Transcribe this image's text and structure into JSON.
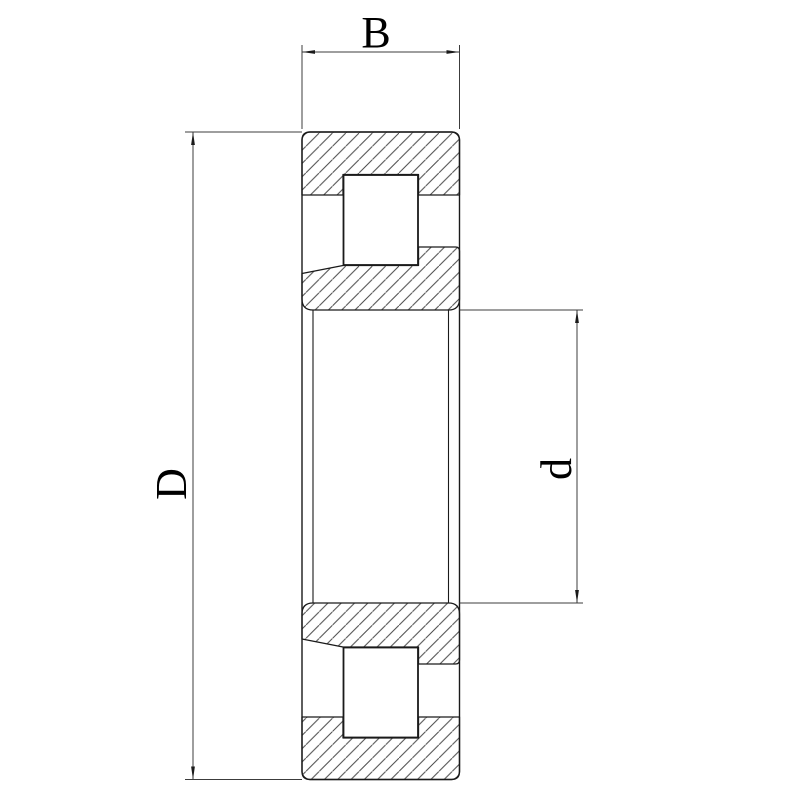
{
  "drawing": {
    "labels": {
      "width": "B",
      "outer_diameter": "D",
      "bore_diameter": "d"
    }
  },
  "colors": {
    "background": "#ffffff",
    "outline": "#1a1a1a",
    "hatch": "#4a4a4a",
    "dimension": "#3c3c3c",
    "text": "#000000"
  }
}
